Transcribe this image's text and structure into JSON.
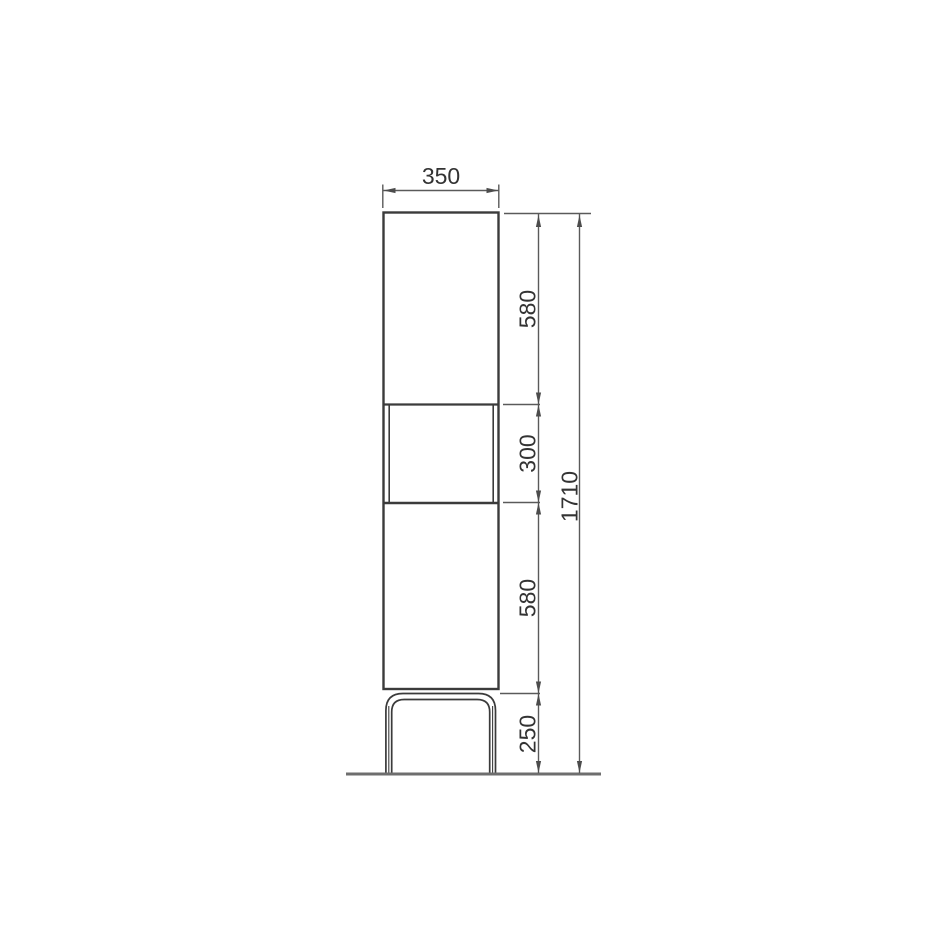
{
  "drawing": {
    "width_dimension": {
      "label": "350"
    },
    "height_segments": [
      {
        "label": "580"
      },
      {
        "label": "300"
      },
      {
        "label": "580"
      },
      {
        "label": "250"
      }
    ],
    "overall_height": {
      "label": "1710"
    },
    "colors": {
      "background": "#ffffff",
      "outline": "#3b3b3b",
      "dimension_lines": "#5a5a5a",
      "floor_line": "#6e6e6e",
      "label_text": "#333333"
    }
  }
}
